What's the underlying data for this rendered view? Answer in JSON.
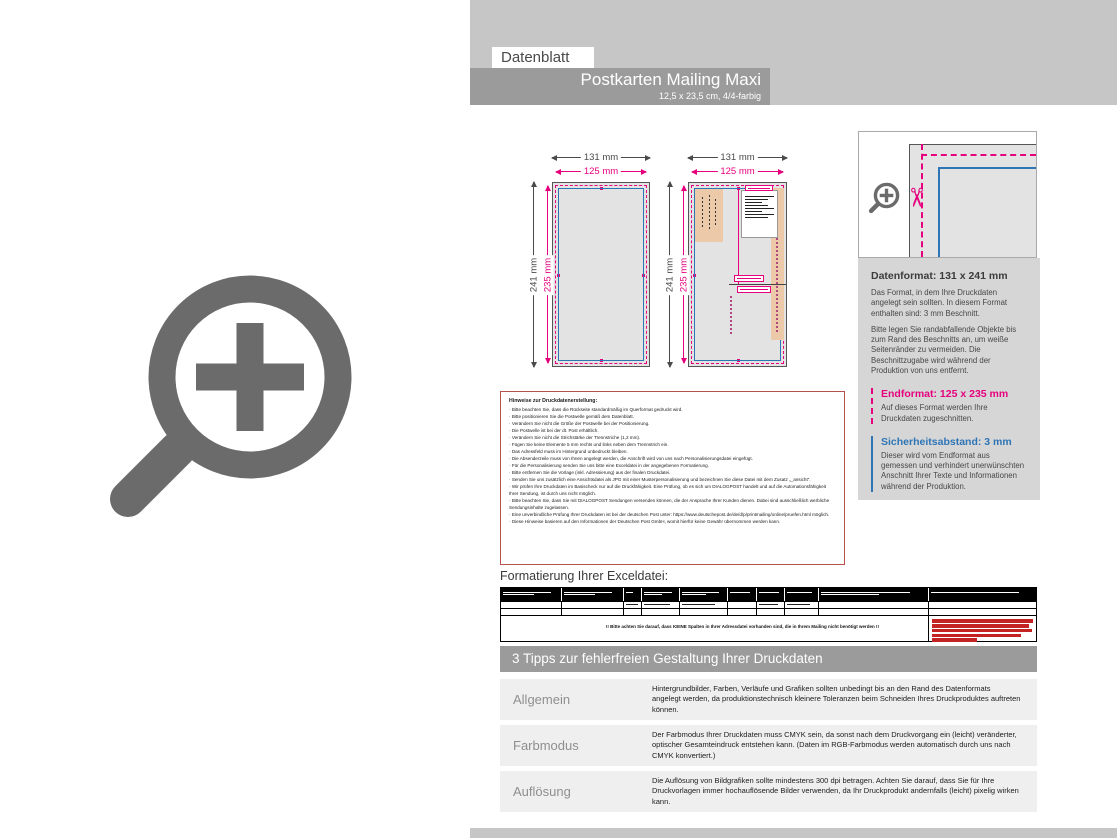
{
  "colors": {
    "magenta": "#e6007e",
    "blue": "#2e75b6",
    "panel_gray": "#c6c6c6",
    "bar_gray": "#9b9b9b",
    "tan_zone": "#eccaa9",
    "icon_gray": "#6b6b6b",
    "hinweise_border_red": "#b5524c",
    "red_note": "#c42323"
  },
  "header": {
    "sheet_label": "Datenblatt",
    "title": "Postkarten Mailing Maxi",
    "subtitle": "12,5 x 23,5 cm, 4/4-farbig"
  },
  "diagrams": {
    "front": {
      "width_outer": "131 mm",
      "width_inner": "125 mm",
      "height_outer": "241 mm",
      "height_inner": "235 mm"
    },
    "back": {
      "width_outer": "131 mm",
      "width_inner": "125 mm",
      "height_outer": "241 mm",
      "height_inner": "235 mm"
    }
  },
  "infobox": {
    "datenformat_title": "Datenformat: 131 x 241 mm",
    "datenformat_p1": "Das Format, in dem Ihre Druckdaten angelegt sein sollten. In diesem Format enthalten sind: 3 mm Beschnitt.",
    "datenformat_p2": "Bitte legen Sie randabfallende Objekte bis zum Rand des Beschnitts an, um weiße Seitenränder zu vermeiden. Die Beschnittzugabe wird während der Produktion von uns entfernt.",
    "endformat_title": "Endformat: 125 x 235 mm",
    "endformat_text": "Auf dieses Format werden Ihre Druckdaten zugeschnitten.",
    "sicherheit_title": "Sicherheitsabstand: 3 mm",
    "sicherheit_text": "Dieser wird vom Endformat aus gemessen und verhindert unerwünschten Anschnitt Ihrer Texte und Informationen während der Produktion."
  },
  "hinweise": {
    "title": "Hinweise zur Druckdatenerstellung:",
    "items": [
      "Bitte beachten Sie, dass die Rückseite standardmäßig im Querformat gedruckt wird.",
      "Bitte positionieren Sie die Postwelle gemäß dem Datenblatt.",
      "Verändern Sie nicht die Größe der Postwelle bei der Positionierung.",
      "Die Postwelle ist bei der dt. Post erhältlich.",
      "Verändern Sie nicht die Strichstärke der Trennstriche (1,2 mm).",
      "Fügen Sie keine Elemente 5 mm rechts und links neben dem Trennstrich ein.",
      "Das Adressfeld muss im Hintergrund unbedruckt bleiben.",
      "Die Absenderzeile muss von Ihnen angelegt werden, die Anschrift wird von uns nach Personalisierungsdatei eingefügt.",
      "Für die Personalisierung senden Sie uns bitte eine Exceldatei in der angegebenen Formatierung.",
      "Bitte entfernen Sie die Vorlage (inkl. Adressierung) aus der finalen Druckdatei.",
      "Senden Sie uns zusätzlich eine Ansichtsdatei als JPG mit einer Musterpersonalisierung und bezeichnen Sie diese Datei mit dem Zusatz „_ansicht“.",
      "Wir prüfen Ihre Druckdaten im Basischeck nur auf die Druckfähigkeit. Eine Prüfung, ob es sich um DIALOGPOST handelt und auf die Automationsfähigkeit Ihrer Sendung, ist durch uns nicht möglich.",
      "Bitte beachten Sie, dass Sie mit DIALOGPOST Sendungen versenden können, die der Ansprache Ihrer Kunden dienen. Dabei sind ausschließlich werbliche Sendungsinhalte zugelassen.",
      "Eine unverbindliche Prüfung Ihrer Druckdaten ist bei der deutschen Post unter: https://www.deutschepost.de/de/d/p/printmailing/online/pruefen.html möglich.",
      "Diese Hinweise basieren auf den Informationen der Deutschen Post GmbH, womit hierfür keine Gewähr übernommen werden kann."
    ]
  },
  "excel": {
    "heading": "Formatierung Ihrer Exceldatei:",
    "warning": "!! Bitte achten Sie darauf, dass KEINE Spalten in Ihrer Adressdatei vorhanden sind, die in Ihrem Mailing nicht benötigt werden !!"
  },
  "tipps": {
    "title": "3 Tipps zur fehlerfreien Gestaltung Ihrer Druckdaten",
    "rows": [
      {
        "label": "Allgemein",
        "text": "Hintergrundbilder, Farben, Verläufe und Grafiken sollten unbedingt bis an den Rand des Datenformats angelegt werden, da produktionstechnisch kleinere Toleranzen beim Schneiden Ihres Druckproduktes auftreten können."
      },
      {
        "label": "Farbmodus",
        "text": "Der Farbmodus Ihrer Druckdaten muss CMYK sein, da sonst nach dem Druckvorgang ein (leicht) veränderter, optischer Gesamteindruck entstehen kann. (Daten im RGB-Farbmodus werden automatisch durch uns nach CMYK konvertiert.)"
      },
      {
        "label": "Auflösung",
        "text": "Die Auflösung von Bildgrafiken sollte mindestens 300 dpi betragen. Achten Sie darauf, dass Sie für Ihre Druckvorlagen immer hochauflösende Bilder verwenden, da Ihr Druckprodukt andernfalls (leicht) pixelig wirken kann."
      }
    ]
  },
  "scissors_icon": "✂"
}
